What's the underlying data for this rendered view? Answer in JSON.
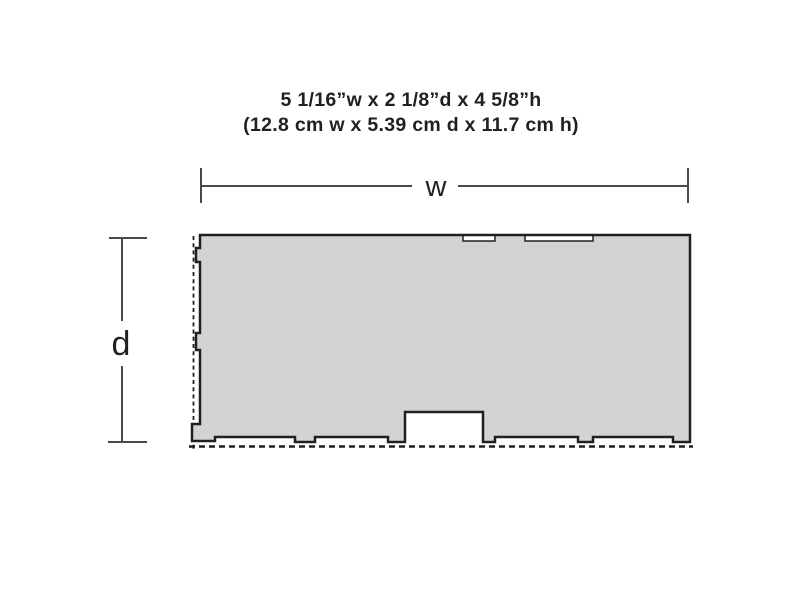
{
  "title": {
    "imperial": "5 1/16”w x 2 1/8”d x 4 5/8”h",
    "metric": "(12.8 cm w x 5.39 cm d x 11.7 cm h)"
  },
  "labels": {
    "width": "w",
    "depth": "d"
  },
  "colors": {
    "background": "#ffffff",
    "footprint_fill": "#d1d3d4",
    "outline": "#231f20",
    "dimension_line": "#4a4a4a",
    "text": "#231f20"
  }
}
